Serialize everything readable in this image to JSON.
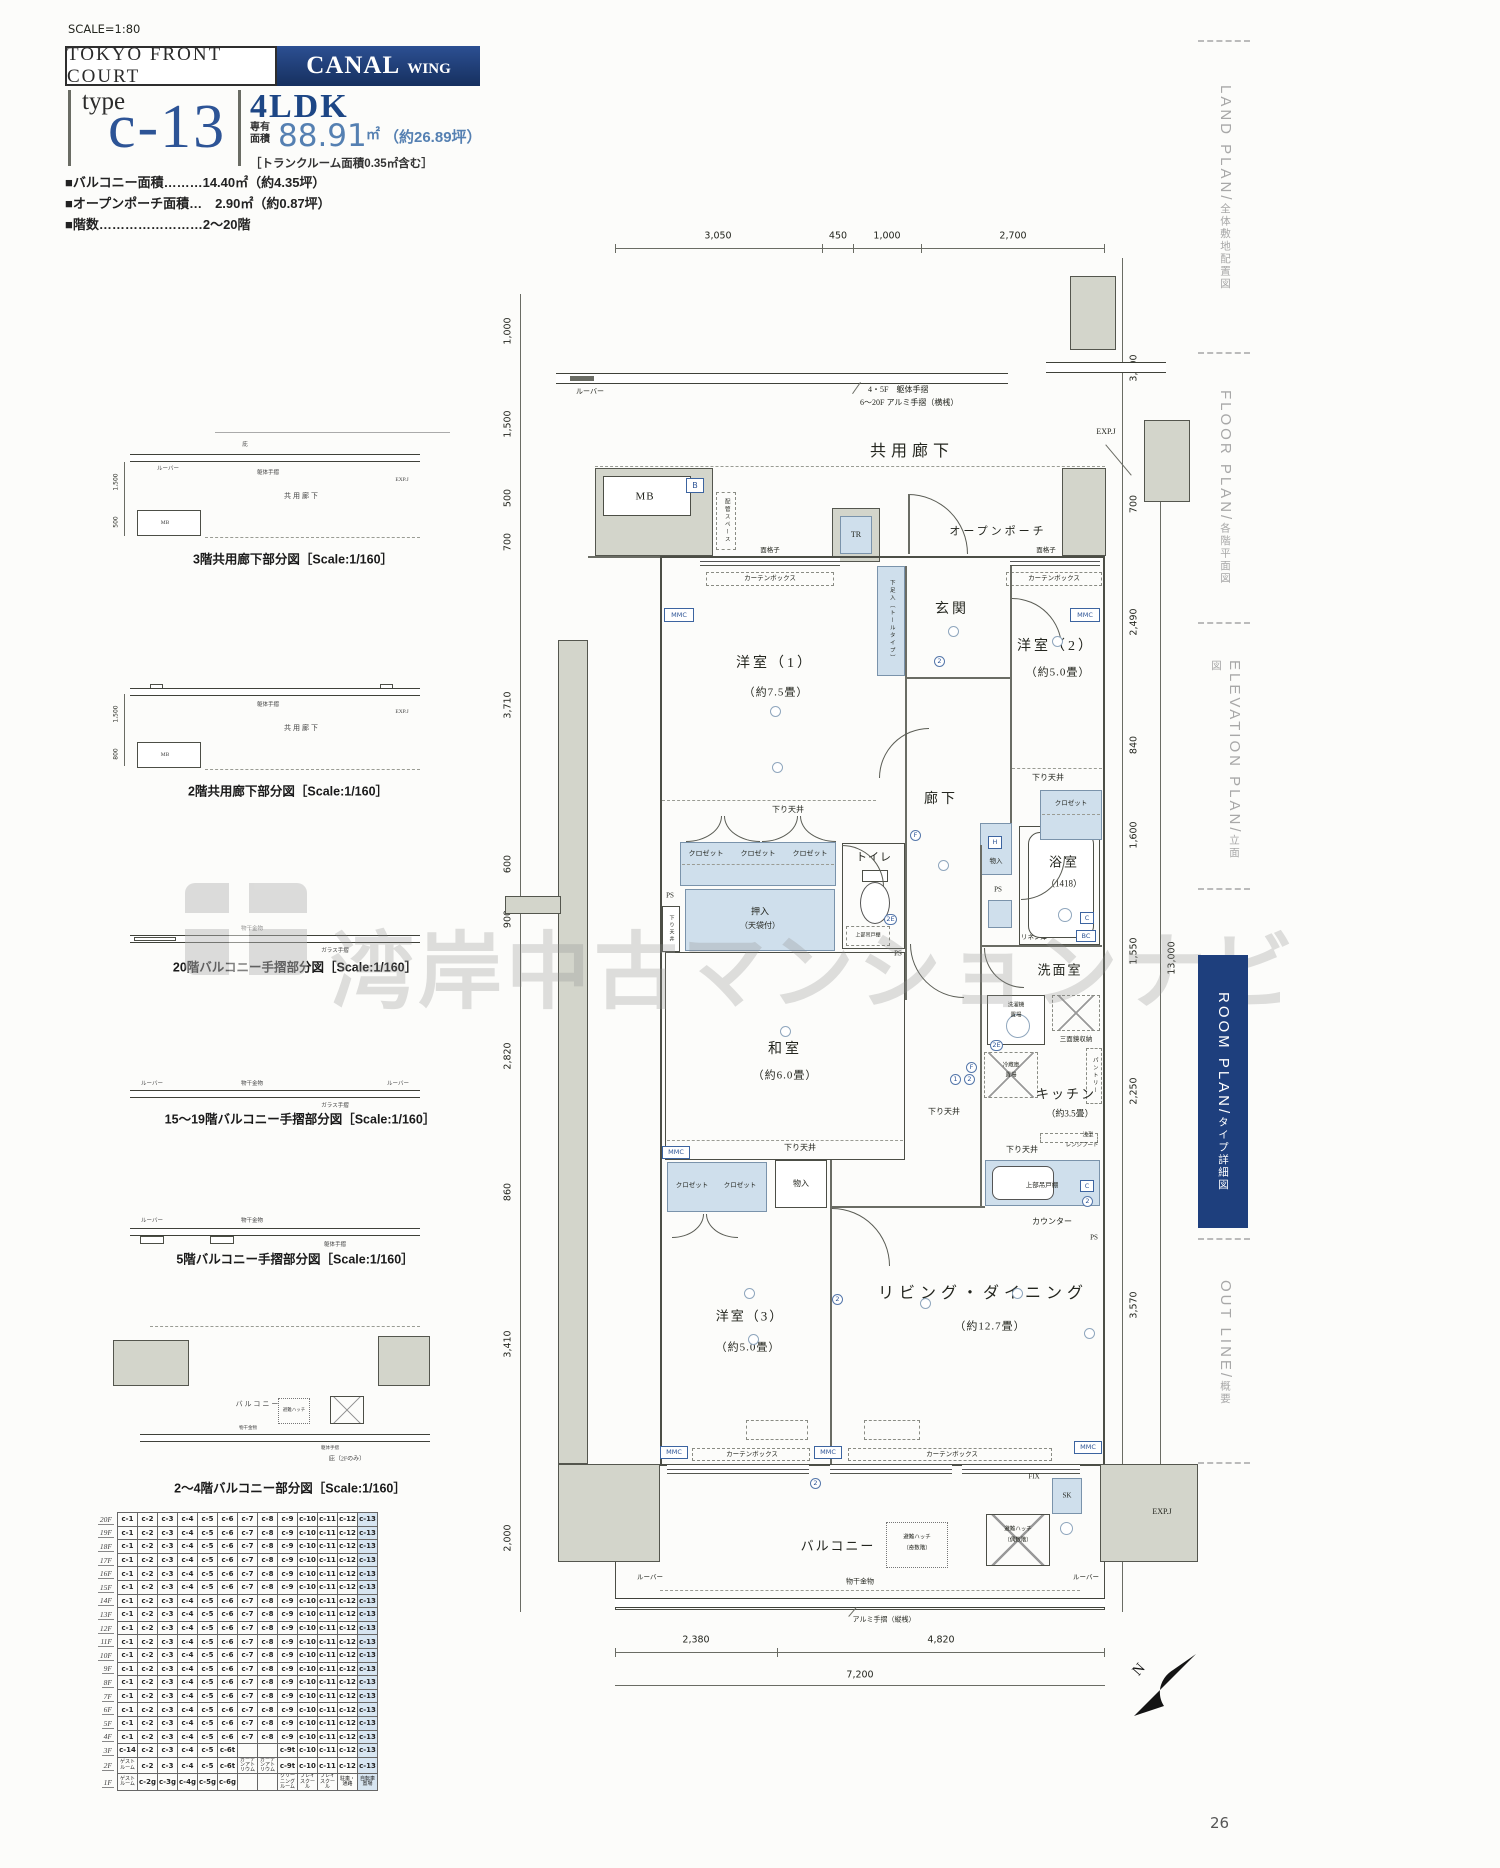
{
  "page": {
    "scale": "SCALE=1:80",
    "number": "26"
  },
  "header": {
    "project": "TOKYO FRONT COURT",
    "wing_name": "CANAL",
    "wing_sub": "WING",
    "type_word": "type",
    "type_code": "c-13",
    "layout": "4LDK",
    "area_prefix_1": "専有",
    "area_prefix_2": "面積",
    "area_value": "88.91",
    "area_unit": "㎡",
    "area_tsubo": "（約26.89坪）",
    "trunk_note": "［トランクルーム面積0.35㎡含む］",
    "bullets": [
      "■バルコニー面積………14.40㎡（約4.35坪）",
      "■オープンポーチ面積…　2.90㎡（約0.87坪）",
      "■階数……………………2～20階"
    ]
  },
  "minis": {
    "captions": [
      "3階共用廊下部分図［Scale:1/160］",
      "2階共用廊下部分図［Scale:1/160］",
      "20階バルコニー手摺部分図［Scale:1/160］",
      "15～19階バルコニー手摺部分図［Scale:1/160］",
      "5階バルコニー手摺部分図［Scale:1/160］",
      "2～4階バルコニー部分図［Scale:1/160］"
    ],
    "labels": {
      "hisashi": "庇",
      "corridor": "共用廊下",
      "mb": "MB",
      "expj": "EXP.J",
      "louver": "ルーバー",
      "kutai": "躯体手摺",
      "glass": "ガラス手摺",
      "monohoshi": "物干金物",
      "balcony": "バルコニー",
      "hatch": "避難ハッチ",
      "hisashi2f": "庇（2Fのみ）",
      "d1500": "1,500",
      "d500": "500",
      "d800": "800"
    }
  },
  "floor_table": {
    "standard_cells": [
      "c-1",
      "c-2",
      "c-3",
      "c-4",
      "c-5",
      "c-6",
      "c-7",
      "c-8",
      "c-9",
      "c-10",
      "c-11",
      "c-12",
      "c-13"
    ],
    "rows": [
      {
        "floor": "20F",
        "cells": "std"
      },
      {
        "floor": "19F",
        "cells": "std"
      },
      {
        "floor": "18F",
        "cells": "std"
      },
      {
        "floor": "17F",
        "cells": "std"
      },
      {
        "floor": "16F",
        "cells": "std"
      },
      {
        "floor": "15F",
        "cells": "std"
      },
      {
        "floor": "14F",
        "cells": "std"
      },
      {
        "floor": "13F",
        "cells": "std"
      },
      {
        "floor": "12F",
        "cells": "std"
      },
      {
        "floor": "11F",
        "cells": "std"
      },
      {
        "floor": "10F",
        "cells": "std"
      },
      {
        "floor": "9F",
        "cells": "std"
      },
      {
        "floor": "8F",
        "cells": "std"
      },
      {
        "floor": "7F",
        "cells": "std"
      },
      {
        "floor": "6F",
        "cells": "std"
      },
      {
        "floor": "5F",
        "cells": "std"
      },
      {
        "floor": "4F",
        "cells": "std"
      },
      {
        "floor": "3F",
        "cells": [
          "c-14",
          "c-2",
          "c-3",
          "c-4",
          "c-5",
          "c-6t",
          "",
          "",
          "c-9t",
          "c-10",
          "c-11",
          "c-12",
          "c-13"
        ]
      },
      {
        "floor": "2F",
        "cells": [
          "ゲストルーム",
          "c-2",
          "c-3",
          "c-4",
          "c-5",
          "c-6t",
          "ガーデンアトリウム",
          "ガーデンアトリウム",
          "c-9t",
          "c-10",
          "c-11",
          "c-12",
          "c-13"
        ]
      },
      {
        "floor": "1F",
        "cells": [
          "ゲストルーム",
          "c-2g",
          "c-3g",
          "c-4g",
          "c-5g",
          "c-6g",
          "",
          "",
          "クリーニングルーム",
          "プレイスクール",
          "プレイスクール",
          "駐車・通路",
          "自転車置場"
        ]
      }
    ],
    "highlight_column": "c-13",
    "highlight_color": "#d7e5f1"
  },
  "plan": {
    "labels": {
      "corridor": "共用廊下",
      "louver": "ルーバー",
      "rail_note1": "4・5F　躯体手摺",
      "rail_note2": "6～20F アルミ手摺（横桟）",
      "expj": "EXP.J",
      "mb": "MB",
      "b": "B",
      "pipe_space": "配管スペース",
      "grille": "面格子",
      "curtain_box": "カーテンボックス",
      "mmc": "MMC",
      "tr": "TR",
      "open_porch": "オープンポーチ",
      "entrance": "玄関",
      "shoe_box": "下足入（トールタイプ）",
      "bed1": "洋室（1）",
      "bed1_size": "（約7.5畳）",
      "bed2": "洋室（2）",
      "bed2_size": "（約5.0畳）",
      "bed3": "洋室（3）",
      "bed3_size": "（約5.0畳）",
      "closet": "クロゼット",
      "lowered_ceiling": "下り天井",
      "hall": "廊下",
      "toilet": "トイレ",
      "upper_cabinet": "上部吊戸棚",
      "ps": "PS",
      "oshiire1": "押入",
      "oshiire2": "（天袋付）",
      "washitsu": "和室",
      "washitsu_size": "（約6.0畳）",
      "bath": "浴室",
      "bath_size": "（1418）",
      "mono_iri": "物入",
      "h": "H",
      "f": "F",
      "c": "C",
      "bc": "BC",
      "e2": "2E",
      "n1": "1",
      "n2": "2",
      "linen": "リネン庫",
      "senmen": "洗面室",
      "laundry1": "洗濯機",
      "laundry2": "置場",
      "mirror": "三面鏡収納",
      "fridge1": "冷蔵庫",
      "fridge2": "置場",
      "pantry": "パントリー",
      "kitchen": "キッチン",
      "kitchen_size": "（約3.5畳）",
      "hood1": "浅型",
      "hood2": "レンジフード",
      "counter": "カウンター",
      "living": "リビング・ダイニング",
      "living_size": "（約12.7畳）",
      "fix": "FIX",
      "sk": "SK",
      "balcony": "バルコニー",
      "hatch": "避難ハッチ",
      "hatch_odd": "（奇数階）",
      "hatch_even": "（偶数階）",
      "monohoshi": "物干金物",
      "alumi_rail": "アルミ手摺（縦桟）"
    },
    "dims": {
      "top": [
        "3,050",
        "450",
        "1,000",
        "2,700"
      ],
      "left": [
        "1,000",
        "1,500",
        "500",
        "700",
        "3,710",
        "600",
        "900",
        "2,820",
        "860",
        "3,410",
        "2,000"
      ],
      "right": [
        "3,000",
        "700",
        "2,490",
        "840",
        "1,600",
        "1,550",
        "2,250",
        "3,570",
        "2,000"
      ],
      "right_total": "13,000",
      "bottom": [
        "2,380",
        "4,820"
      ],
      "bottom_total": "7,200"
    }
  },
  "sidebar": {
    "tabs": [
      {
        "en": "LAND PLAN",
        "jp": "全体敷地配置図",
        "active": false
      },
      {
        "en": "FLOOR PLAN",
        "jp": "各階平面図",
        "active": false
      },
      {
        "en": "ELEVATION PLAN",
        "jp": "立面図",
        "active": false
      },
      {
        "en": "ROOM PLAN",
        "jp": "タイプ詳細図",
        "active": true
      },
      {
        "en": "OUT LINE",
        "jp": "概要",
        "active": false
      }
    ]
  },
  "watermark": {
    "text": "湾岸中古マンションナビ"
  },
  "compass": {
    "n": "N"
  }
}
